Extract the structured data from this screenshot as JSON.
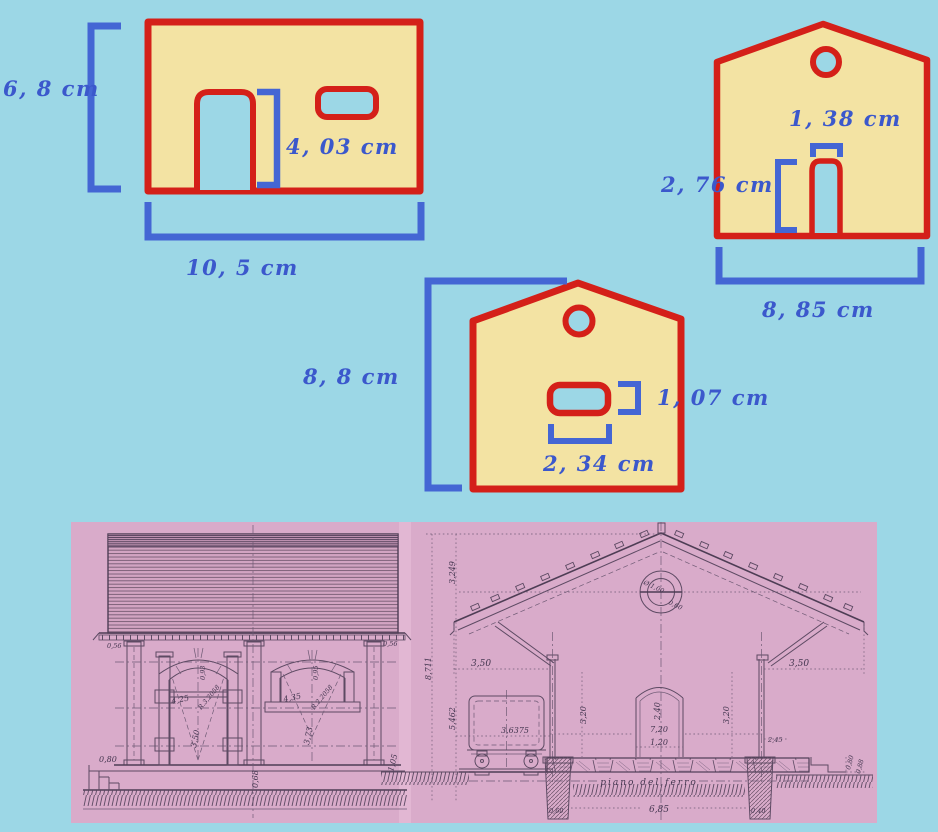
{
  "colors": {
    "background": "#9cd7e6",
    "wall_fill": "#f3e3a3",
    "outline_red": "#d42019",
    "dimension_blue": "#4466d4",
    "label_text_blue": "#3b58cc",
    "scan_pink": "#d9abca",
    "scan_line": "#5d4a63"
  },
  "shape_diagram": {
    "front_wall": {
      "height": "6, 8  cm",
      "door_height": "4, 03  cm",
      "width": "10, 5  cm"
    },
    "gable_wall_top": {
      "door_width": "1, 38  cm",
      "door_height": "2, 76  cm",
      "width": "8, 85  cm"
    },
    "gable_wall_bottom": {
      "height": "8, 8  cm",
      "window_height": "1, 07  cm",
      "window_width": "2, 34  cm"
    }
  },
  "blueprint": {
    "side_elevation": {
      "eave_left": "0,56",
      "eave_right": "0,56",
      "platform_height": "0,80",
      "door_arch_rise": "0,93",
      "door_radius": "R.3,2058",
      "door_width": "4,25",
      "door_height": "3,50",
      "window_arch_rise": "0,95",
      "window_radius": "R.2,2058",
      "window_width": "4,35",
      "window_height": "3,73",
      "base_center": "0,68",
      "base_right": "1,05"
    },
    "cross_section": {
      "roof_rise": "3,249",
      "total_height": "8,711",
      "eaves_height": "5,462",
      "overhang_left": "3,50",
      "overhang_right": "3,50",
      "oculus_diameter": "Ø 1,00",
      "oculus_inner": "0,60",
      "wagon_clearance": "3,6375",
      "wall_height_left": "3,20",
      "wall_height_right": "3,20",
      "door_height": "2,40",
      "inner_width": "7,20",
      "door_width": "1,20",
      "platform_offset": "2,45",
      "step_a": "0,80",
      "step_b": "0,88",
      "ground_label": "piano del ferro",
      "foundation_span": "6,85",
      "pier_left": "0,60",
      "pier_right": "0,40"
    }
  }
}
